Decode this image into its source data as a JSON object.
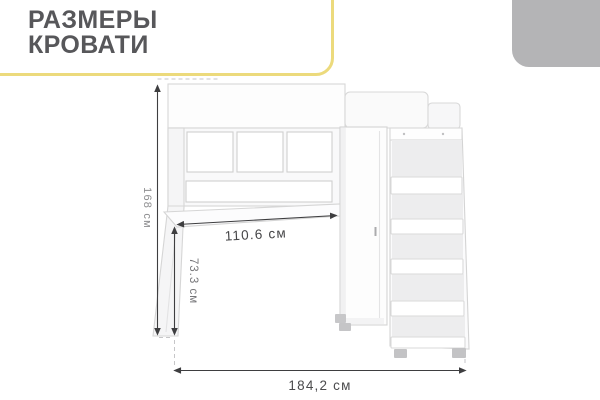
{
  "header": {
    "title_line1": "РАЗМЕРЫ",
    "title_line2": "КРОВАТИ"
  },
  "colors": {
    "accent_yellow": "#ecda7c",
    "corner_gray": "#b4b4b6",
    "title_text": "#57575a",
    "dimension_line": "#3e3e40",
    "dimension_text_dark": "#4b4b4d",
    "dimension_text_light": "#8e8e90",
    "drawing_stroke": "#d6d6d6"
  },
  "diagram": {
    "type": "furniture-dimension-diagram",
    "subject": "loft bed with desk, wardrobe and ladder shelves",
    "dimension_labels": {
      "height": "168 см",
      "desk_width": "110.6 см",
      "desk_height": "73.3 см",
      "total_width": "184,2 см"
    }
  }
}
